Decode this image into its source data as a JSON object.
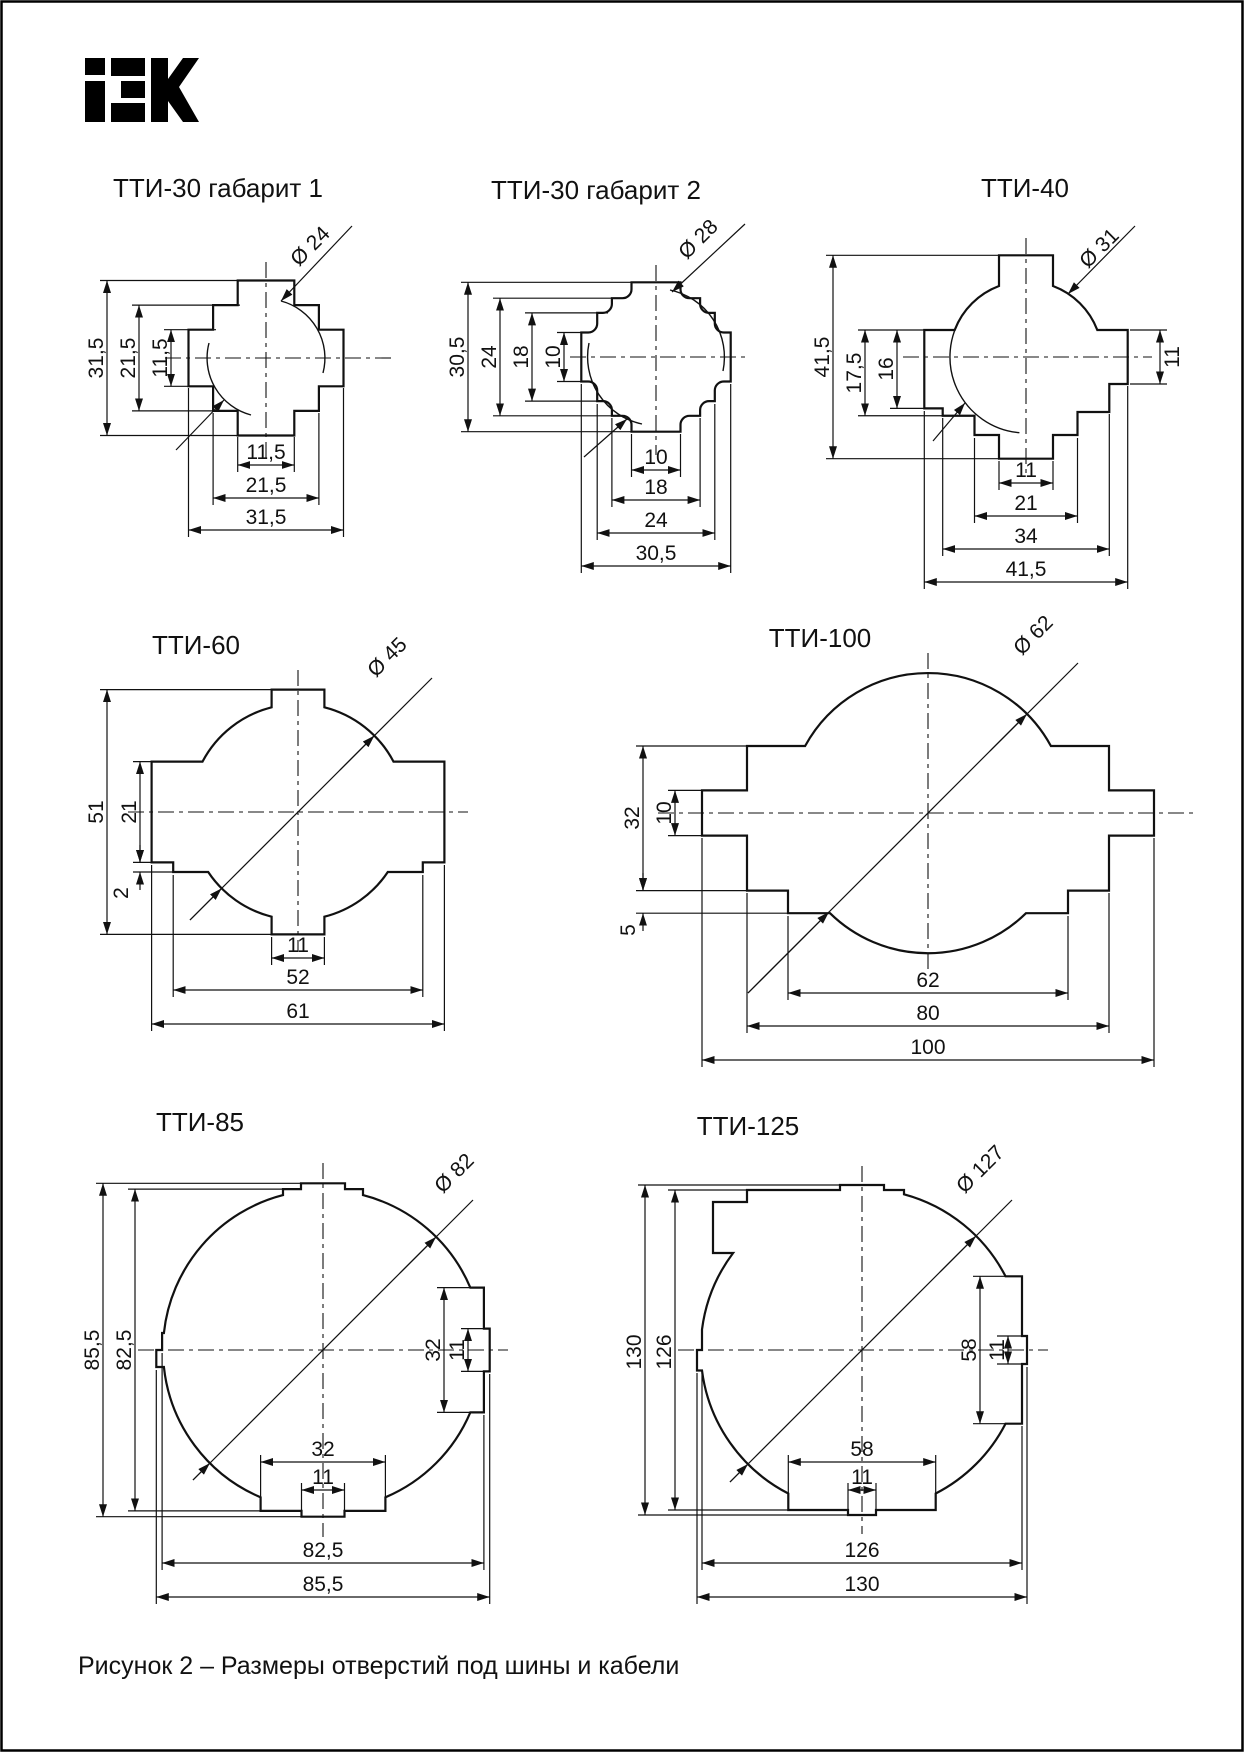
{
  "page": {
    "brand": "IEK",
    "caption": "Рисунок 2 – Размеры отверстий под шины и кабели"
  },
  "drawings": [
    {
      "title": "ТТИ-30 габарит 1",
      "diameter": "Ø 24",
      "dims": {
        "v1": "31,5",
        "v2": "21,5",
        "v3": "11,5",
        "h1": "11,5",
        "h2": "21,5",
        "h3": "31,5"
      }
    },
    {
      "title": "ТТИ-30 габарит 2",
      "diameter": "Ø 28",
      "dims": {
        "v1": "30,5",
        "v2": "24",
        "v3": "18",
        "v4": "10",
        "h1": "10",
        "h2": "18",
        "h3": "24",
        "h4": "30,5"
      }
    },
    {
      "title": "ТТИ-40",
      "diameter": "Ø 31",
      "dims": {
        "v1": "41,5",
        "v2": "17,5",
        "v3": "16",
        "r1": "11",
        "h1": "11",
        "h2": "21",
        "h3": "34",
        "h4": "41,5"
      }
    },
    {
      "title": "ТТИ-60",
      "diameter": "Ø 45",
      "dims": {
        "v1": "51",
        "v2": "21",
        "v3": "2",
        "h1": "11",
        "h2": "52",
        "h3": "61"
      }
    },
    {
      "title": "ТТИ-100",
      "diameter": "Ø 62",
      "dims": {
        "v1": "32",
        "v2": "10",
        "v3": "5",
        "h1": "62",
        "h2": "80",
        "h3": "100"
      }
    },
    {
      "title": "ТТИ-85",
      "diameter": "Ø 82",
      "dims": {
        "v1": "85,5",
        "v2": "82,5",
        "r1": "32",
        "r2": "11",
        "b1": "32",
        "b2": "11",
        "h1": "82,5",
        "h2": "85,5"
      }
    },
    {
      "title": "ТТИ-125",
      "diameter": "Ø 127",
      "dims": {
        "v1": "130",
        "v2": "126",
        "r1": "58",
        "r2": "11",
        "b1": "58",
        "b2": "11",
        "h1": "126",
        "h2": "130"
      }
    }
  ]
}
